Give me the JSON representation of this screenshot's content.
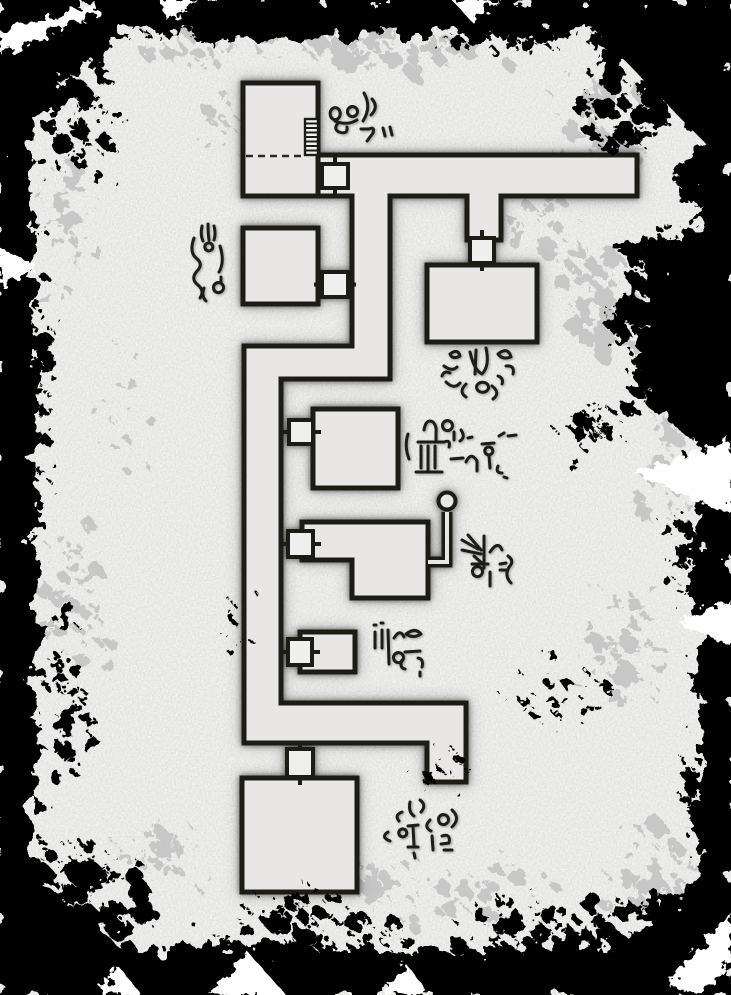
{
  "map": {
    "type": "dungeon-map",
    "canvas": {
      "width": 731,
      "height": 995
    },
    "colors": {
      "background": "#f4f4f2",
      "floor": "#e8e7e5",
      "wall": "#1a1a18",
      "door_fill": "#efefed",
      "ink": "#1c1c1a",
      "speckle_gray": "#c7c7c7",
      "splatter_black": "#060606"
    },
    "corridor_path": "M318,155 L637,155 L637,196 L501,196 L501,240 L467,240 L467,196 L390,196 L390,379 L281,379 L281,703 L466,703 L466,782 L427,782 L427,743 L244,743 L244,346 L352,346 L352,196 L318,196 Z",
    "rooms": [
      {
        "id": "room-1",
        "kind": "stair-room",
        "x": 243,
        "y": 83,
        "w": 75,
        "h": 113
      },
      {
        "id": "room-2",
        "kind": "room",
        "x": 243,
        "y": 228,
        "w": 75,
        "h": 76
      },
      {
        "id": "room-3",
        "kind": "room",
        "x": 427,
        "y": 265,
        "w": 110,
        "h": 77
      },
      {
        "id": "room-4",
        "kind": "room",
        "x": 313,
        "y": 409,
        "w": 85,
        "h": 79
      },
      {
        "id": "room-5",
        "kind": "l-room",
        "points": "302,522 428,522 428,598 352,598 352,560 302,560"
      },
      {
        "id": "room-6",
        "kind": "small-room",
        "x": 300,
        "y": 632,
        "w": 55,
        "h": 40
      },
      {
        "id": "room-7",
        "kind": "room",
        "x": 242,
        "y": 778,
        "w": 115,
        "h": 114
      }
    ],
    "doors": [
      {
        "id": "door-1",
        "x": 322,
        "y": 164,
        "w": 26,
        "h": 24,
        "o": "v"
      },
      {
        "id": "door-2",
        "x": 322,
        "y": 272,
        "w": 26,
        "h": 25,
        "o": "h"
      },
      {
        "id": "door-3",
        "x": 470,
        "y": 238,
        "w": 24,
        "h": 25,
        "o": "v"
      },
      {
        "id": "door-4",
        "x": 289,
        "y": 420,
        "w": 24,
        "h": 24,
        "o": "h"
      },
      {
        "id": "door-5",
        "x": 288,
        "y": 531,
        "w": 25,
        "h": 26,
        "o": "h"
      },
      {
        "id": "door-6",
        "x": 288,
        "y": 639,
        "w": 24,
        "h": 26,
        "o": "h"
      },
      {
        "id": "door-7",
        "x": 287,
        "y": 749,
        "w": 26,
        "h": 28,
        "o": "v"
      }
    ],
    "features": {
      "stairs": {
        "x": 305,
        "y": 119,
        "w": 13,
        "h": 36,
        "steps": 8
      },
      "divider": {
        "x1": 246,
        "y1": 156,
        "x2": 303,
        "y2": 156
      },
      "well": {
        "path": "M428,562 L447,562 L447,512",
        "cx": 447,
        "cy": 501,
        "r": 8.5
      }
    },
    "runes": [
      {
        "id": "rune-cluster-1",
        "x": 325,
        "y": 85,
        "strokes": [
          "M7,24 a5,6 0 1 1 -0.1,0.1",
          "M24,23 a5,5 0 1 1 -0.1,0.1",
          "M10,36 q12,5 22,-1",
          "M13,38 q-5,6 1,9 q9,3 8,-5",
          "M39,8 q8,14 -1,28",
          "M47,14 q7,8 -1,16",
          "M36,44 l8,0 q6,-3 4,4 l-6,8",
          "M58,43 l2,8",
          "M65,42 l2,8"
        ]
      },
      {
        "id": "rune-cluster-2",
        "x": 190,
        "y": 222,
        "strokes": [
          "M12,4 q-2,9 1,15",
          "M18,2 q0,10 1,16",
          "M24,4 q2,8 0,14",
          "M16,22 a4,4 0 1 1 -0.1,0.1",
          "M4,16 q-5,14 2,20 q8,6 1,13 q-7,8 1,14 q7,6 2,13",
          "M30,24 q5,16 -1,26",
          "M31,55 l0,5",
          "M25,62 a5,5 0 1 1 -0.1,0.1",
          "M14,66 q-3,8 2,13"
        ]
      },
      {
        "id": "rune-cluster-3",
        "x": 440,
        "y": 348,
        "strokes": [
          "M10,6 q8,-6 10,2 q-8,4 -10,-2",
          "M4,18 q8,6 13,1",
          "M2,28 q2,-6 8,-3",
          "M6,34 q8,8 14,1",
          "M30,4 q4,18 12,22 q8,-8 4,-26",
          "M36,2 l-1,24",
          "M58,6 q10,-8 13,3 q-9,3 -13,-3",
          "M66,18 q9,-1 7,8",
          "M58,28 q6,2 4,8",
          "M26,36 q-8,8 0,13",
          "M38,36 a6,5 0 1 1 -0.1,0.1",
          "M52,38 q9,7 1,13"
        ]
      },
      {
        "id": "rune-cluster-4",
        "x": 404,
        "y": 414,
        "strokes": [
          "M4,20 q-4,12 1,25",
          "M20,16 q2,-12 9,-8 q4,4 3,11 l0,7",
          "M40,8 a5,5 0 1 1 -0.1,0.1",
          "M14,28 l26,0 q7,-3 5,5",
          "M17,32 l0,22",
          "M24,32 l0,24",
          "M31,32 l0,22",
          "M12,58 l26,0",
          "M50,18 l0,8",
          "M57,16 q5,7 -1,11",
          "M64,24 l4,-1",
          "M47,45 l12,-1",
          "M62,48 q5,-11 11,-1 l0,10",
          "M78,30 l12,-1",
          "M82,34 a4,4 0 1 1 -0.1,0.1",
          "M85,42 l1,12",
          "M95,22 l5,-3",
          "M104,22 l8,-1",
          "M94,52 q-3,7 4,7",
          "M100,63 l3,1"
        ]
      },
      {
        "id": "rune-cluster-5",
        "x": 460,
        "y": 530,
        "strokes": [
          "M2,10 l16,9",
          "M8,5 l13,15",
          "M2,20 l19,4",
          "M14,26 l10,9",
          "M24,6 l0,32",
          "M12,34 l16,0",
          "M14,38 a5,5 0 1 1 -0.1,0.1",
          "M30,22 q8,-12 12,-2",
          "M30,42 l0,14",
          "M40,34 l6,-1",
          "M40,40 l7,0",
          "M48,26 q7,5 1,11 q-5,9 2,16"
        ]
      },
      {
        "id": "rune-cluster-6",
        "x": 370,
        "y": 622,
        "strokes": [
          "M5,10 l0,16",
          "M4,3 l2,0",
          "M12,8 l0,18",
          "M11,1 l2,0",
          "M18,8 l1,34",
          "M24,16 q6,-10 10,-1",
          "M25,32 a5,5 0 1 1 -0.1,0.1",
          "M36,12 q9,-7 15,0 q-8,5 -15,0",
          "M35,30 l15,-1",
          "M32,38 q-3,8 3,9",
          "M48,36 q6,1 4,9",
          "M50,50 l0,4"
        ]
      },
      {
        "id": "rune-cluster-7",
        "x": 380,
        "y": 800,
        "strokes": [
          "M22,12 q-8,3 -3,9",
          "M30,2 q-2,10 4,14",
          "M40,0 q7,5 1,12",
          "M8,32 q-8,5 2,9",
          "M20,30 a4,4 0 1 1 -0.1,0.1",
          "M28,26 l10,-1",
          "M33,27 l1,18",
          "M28,47 l10,0",
          "M34,53 l1,5",
          "M50,20 q-7,7 1,11",
          "M60,16 a5,5 0 1 1 -0.1,0.1",
          "M72,10 q9,8 0,17",
          "M52,36 l1,14",
          "M62,36 q9,-3 7,7 l-8,1",
          "M64,50 l8,0"
        ]
      }
    ]
  }
}
